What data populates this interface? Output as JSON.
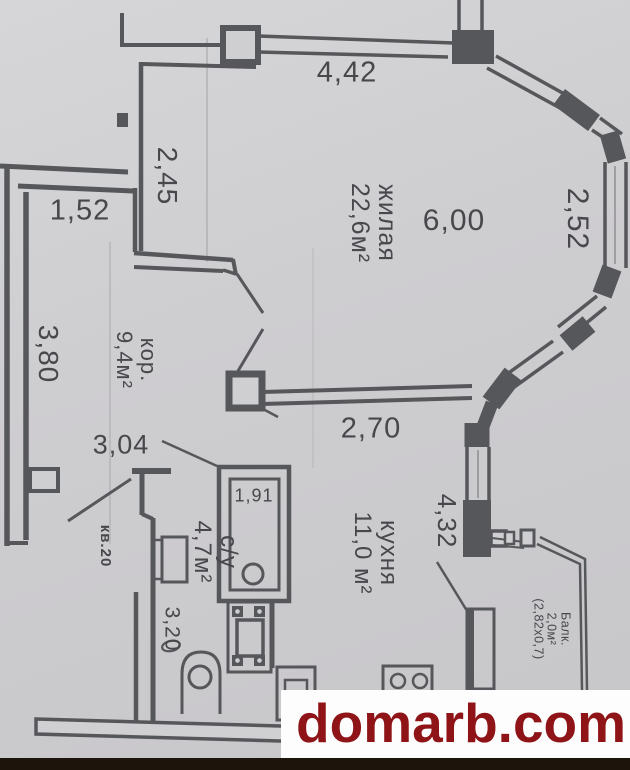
{
  "plan": {
    "apartment_label": "кв.20",
    "rooms": {
      "living": {
        "name": "жилая",
        "area": "22,6м²"
      },
      "corridor": {
        "name": "кор.",
        "area": "9,4м²"
      },
      "bathroom": {
        "name": "с/у",
        "area": "4,7м²"
      },
      "kitchen": {
        "name": "кухня",
        "area": "11,0 м²"
      },
      "balcony": {
        "name": "Балк.",
        "area": "2,0м²",
        "size": "(2,82х0,7)"
      }
    },
    "dimensions": {
      "living_top": "4,42",
      "living_left": "2,45",
      "closet_width": "1,52",
      "living_width": "6,00",
      "bay_right": "2,52",
      "corridor_left": "3,80",
      "hallway_width": "3,04",
      "living_bottom": "2,70",
      "kitchen_right": "4,32",
      "wc_depth": "3,20",
      "bathroom_inner_width": "1,91"
    },
    "colors": {
      "wall": "#56575b",
      "paper": "#cfcfd2",
      "watermark_red": "#8e1418"
    }
  },
  "watermark": {
    "text": "domarb.com"
  }
}
